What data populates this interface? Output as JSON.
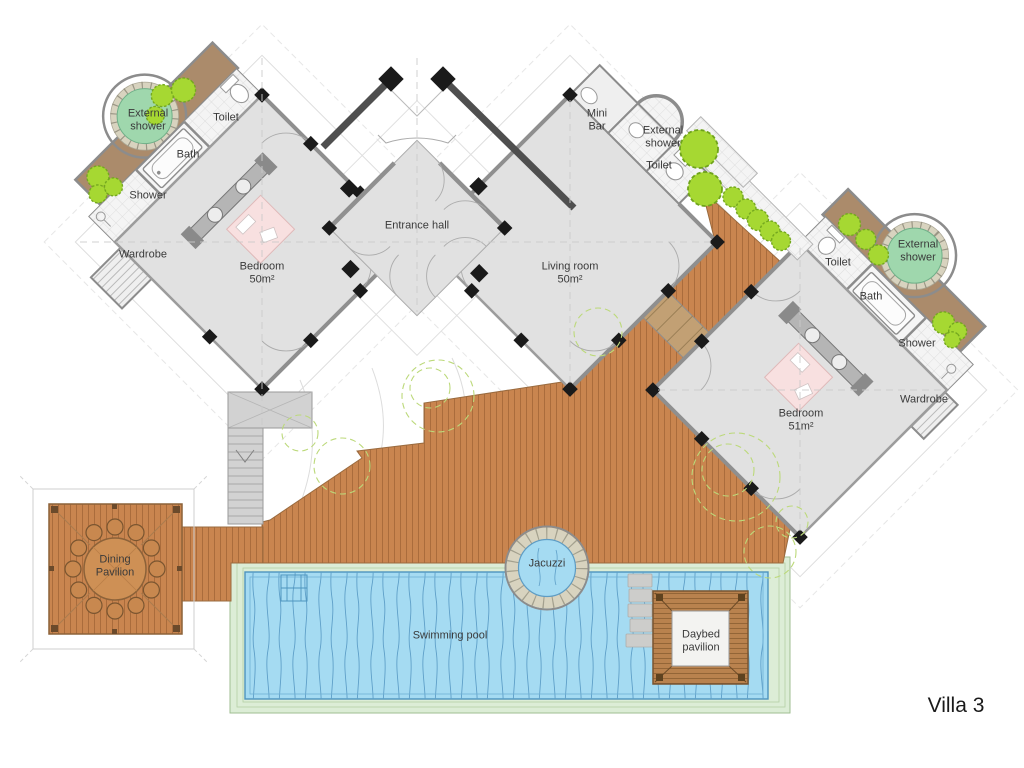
{
  "villa": {
    "name": "Villa 3"
  },
  "rooms": {
    "entrance_hall": {
      "name": "Entrance hall"
    },
    "living_room": {
      "name": "Living room",
      "area": "50m²"
    },
    "bedroom_left": {
      "name": "Bedroom",
      "area": "50m²"
    },
    "bedroom_right": {
      "name": "Bedroom",
      "area": "51m²"
    },
    "mini_bar": {
      "name": "Mini Bar"
    }
  },
  "left_suite": {
    "external_shower": "External shower",
    "toilet": "Toilet",
    "bath": "Bath",
    "shower": "Shower",
    "wardrobe": "Wardrobe"
  },
  "living_annex": {
    "external_shower": "External shower",
    "toilet": "Toilet"
  },
  "right_suite": {
    "external_shower": "External shower",
    "toilet": "Toilet",
    "bath": "Bath",
    "shower": "Shower",
    "wardrobe": "Wardrobe"
  },
  "outdoor": {
    "dining_pavilion": "Dining Pavilion",
    "jacuzzi": "Jacuzzi",
    "swimming_pool": "Swimming pool",
    "daybed_pavilion": "Daybed pavilion"
  },
  "colors": {
    "deck_wood": "#C9854F",
    "deck_plank_line": "#AA6C3C",
    "pool_water": "#A5DBF2",
    "pool_edge": "#4D94BE",
    "pool_surround": "#DCEDD6",
    "garden_soil": "#AB8B6B",
    "bush_green": "#A6D832",
    "shower_pad_green": "#9FD7AD",
    "room_floor": "#E1E1E1",
    "wall_gray": "#8C8C8C",
    "entrance_wall_dark": "#4F4F4F",
    "column_black": "#1A1A1A",
    "bed_pink": "#F8E0E0",
    "stone_ring": "#D8D3BF",
    "wood_steps": "#C2A074"
  }
}
